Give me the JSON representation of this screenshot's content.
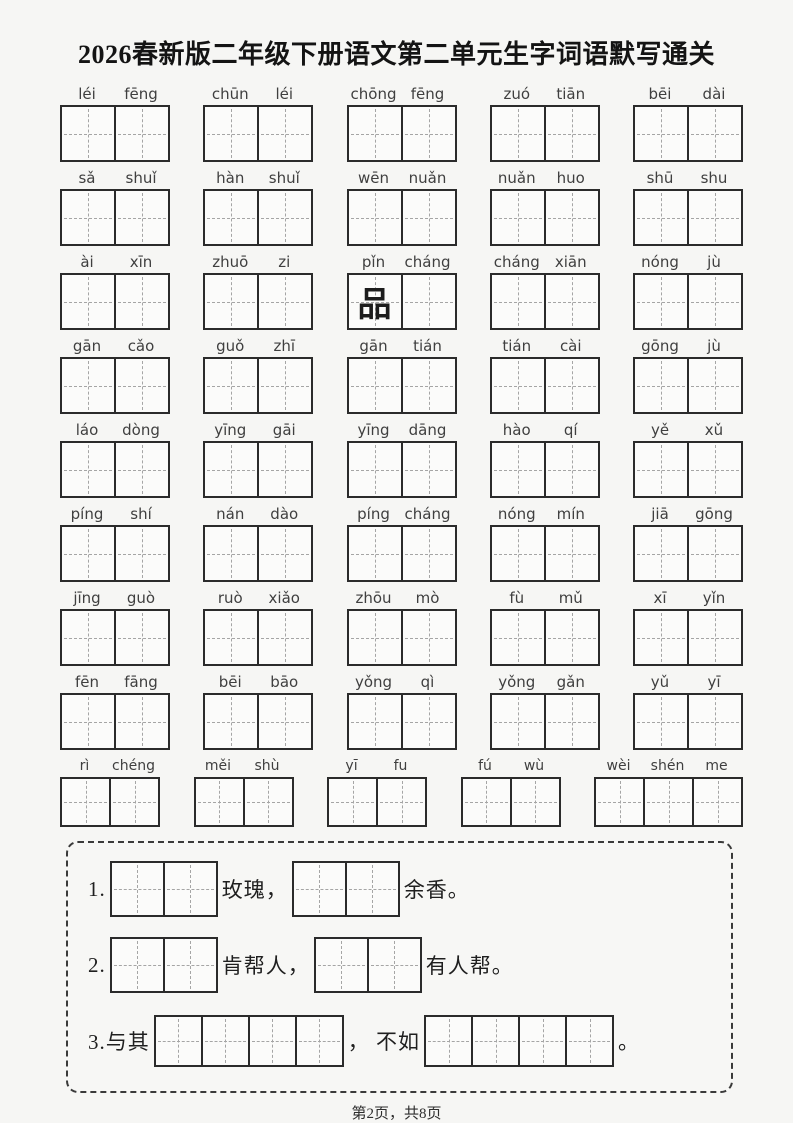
{
  "title": "2026春新版二年级下册语文第二单元生字词语默写通关",
  "footer": "第2页，共8页",
  "colors": {
    "page_background": "#f6f6f4",
    "box_border": "#2b2b2b",
    "guide_dash": "#a5a5a5",
    "pinyin_text": "#3f3f3f",
    "ink_text": "#1c1c1c"
  },
  "word_rows": [
    {
      "small": false,
      "groups": [
        {
          "syllables": [
            "léi",
            "fēng"
          ]
        },
        {
          "syllables": [
            "chūn",
            "léi"
          ]
        },
        {
          "syllables": [
            "chōng",
            "fēng"
          ]
        },
        {
          "syllables": [
            "zuó",
            "tiān"
          ]
        },
        {
          "syllables": [
            "bēi",
            "dài"
          ]
        }
      ]
    },
    {
      "small": false,
      "groups": [
        {
          "syllables": [
            "sǎ",
            "shuǐ"
          ]
        },
        {
          "syllables": [
            "hàn",
            "shuǐ"
          ]
        },
        {
          "syllables": [
            "wēn",
            "nuǎn"
          ]
        },
        {
          "syllables": [
            "nuǎn",
            "huo"
          ]
        },
        {
          "syllables": [
            "shū",
            "shu"
          ]
        }
      ]
    },
    {
      "small": false,
      "groups": [
        {
          "syllables": [
            "ài",
            "xīn"
          ]
        },
        {
          "syllables": [
            "zhuō",
            "zi"
          ]
        },
        {
          "syllables": [
            "pǐn",
            "cháng"
          ],
          "filled": [
            "品",
            ""
          ]
        },
        {
          "syllables": [
            "cháng",
            "xiān"
          ]
        },
        {
          "syllables": [
            "nóng",
            "jù"
          ]
        }
      ]
    },
    {
      "small": false,
      "groups": [
        {
          "syllables": [
            "gān",
            "cǎo"
          ]
        },
        {
          "syllables": [
            "guǒ",
            "zhī"
          ]
        },
        {
          "syllables": [
            "gān",
            "tián"
          ]
        },
        {
          "syllables": [
            "tián",
            "cài"
          ]
        },
        {
          "syllables": [
            "gōng",
            "jù"
          ]
        }
      ]
    },
    {
      "small": false,
      "groups": [
        {
          "syllables": [
            "láo",
            "dòng"
          ]
        },
        {
          "syllables": [
            "yīng",
            "gāi"
          ]
        },
        {
          "syllables": [
            "yīng",
            "dāng"
          ]
        },
        {
          "syllables": [
            "hào",
            "qí"
          ]
        },
        {
          "syllables": [
            "yě",
            "xǔ"
          ]
        }
      ]
    },
    {
      "small": false,
      "groups": [
        {
          "syllables": [
            "píng",
            "shí"
          ]
        },
        {
          "syllables": [
            "nán",
            "dào"
          ]
        },
        {
          "syllables": [
            "píng",
            "cháng"
          ]
        },
        {
          "syllables": [
            "nóng",
            "mín"
          ]
        },
        {
          "syllables": [
            "jiā",
            "gōng"
          ]
        }
      ]
    },
    {
      "small": false,
      "groups": [
        {
          "syllables": [
            "jīng",
            "guò"
          ]
        },
        {
          "syllables": [
            "ruò",
            "xiǎo"
          ]
        },
        {
          "syllables": [
            "zhōu",
            "mò"
          ]
        },
        {
          "syllables": [
            "fù",
            "mǔ"
          ]
        },
        {
          "syllables": [
            "xī",
            "yǐn"
          ]
        }
      ]
    },
    {
      "small": false,
      "groups": [
        {
          "syllables": [
            "fēn",
            "fāng"
          ]
        },
        {
          "syllables": [
            "bēi",
            "bāo"
          ]
        },
        {
          "syllables": [
            "yǒng",
            "qì"
          ]
        },
        {
          "syllables": [
            "yǒng",
            "gǎn"
          ]
        },
        {
          "syllables": [
            "yǔ",
            "yī"
          ]
        }
      ]
    },
    {
      "small": true,
      "groups": [
        {
          "syllables": [
            "rì",
            "chéng"
          ]
        },
        {
          "syllables": [
            "měi",
            "shù"
          ]
        },
        {
          "syllables": [
            "yī",
            "fu"
          ]
        },
        {
          "syllables": [
            "fú",
            "wù"
          ]
        },
        {
          "syllables": [
            "wèi",
            "shén",
            "me"
          ]
        }
      ]
    }
  ],
  "exercises": [
    {
      "segments": [
        {
          "t": "text",
          "v": "1."
        },
        {
          "t": "blank",
          "cells": 2
        },
        {
          "t": "text",
          "v": "玫瑰，"
        },
        {
          "t": "blank",
          "cells": 2
        },
        {
          "t": "text",
          "v": "余香。"
        }
      ]
    },
    {
      "segments": [
        {
          "t": "text",
          "v": "2."
        },
        {
          "t": "blank",
          "cells": 2
        },
        {
          "t": "text",
          "v": "肯帮人，"
        },
        {
          "t": "blank",
          "cells": 2
        },
        {
          "t": "text",
          "v": "有人帮。"
        }
      ]
    },
    {
      "segments": [
        {
          "t": "text",
          "v": "3.与其"
        },
        {
          "t": "blank",
          "cells": 4
        },
        {
          "t": "text",
          "v": "， 不如"
        },
        {
          "t": "blank",
          "cells": 4
        },
        {
          "t": "text",
          "v": "。"
        }
      ]
    }
  ]
}
